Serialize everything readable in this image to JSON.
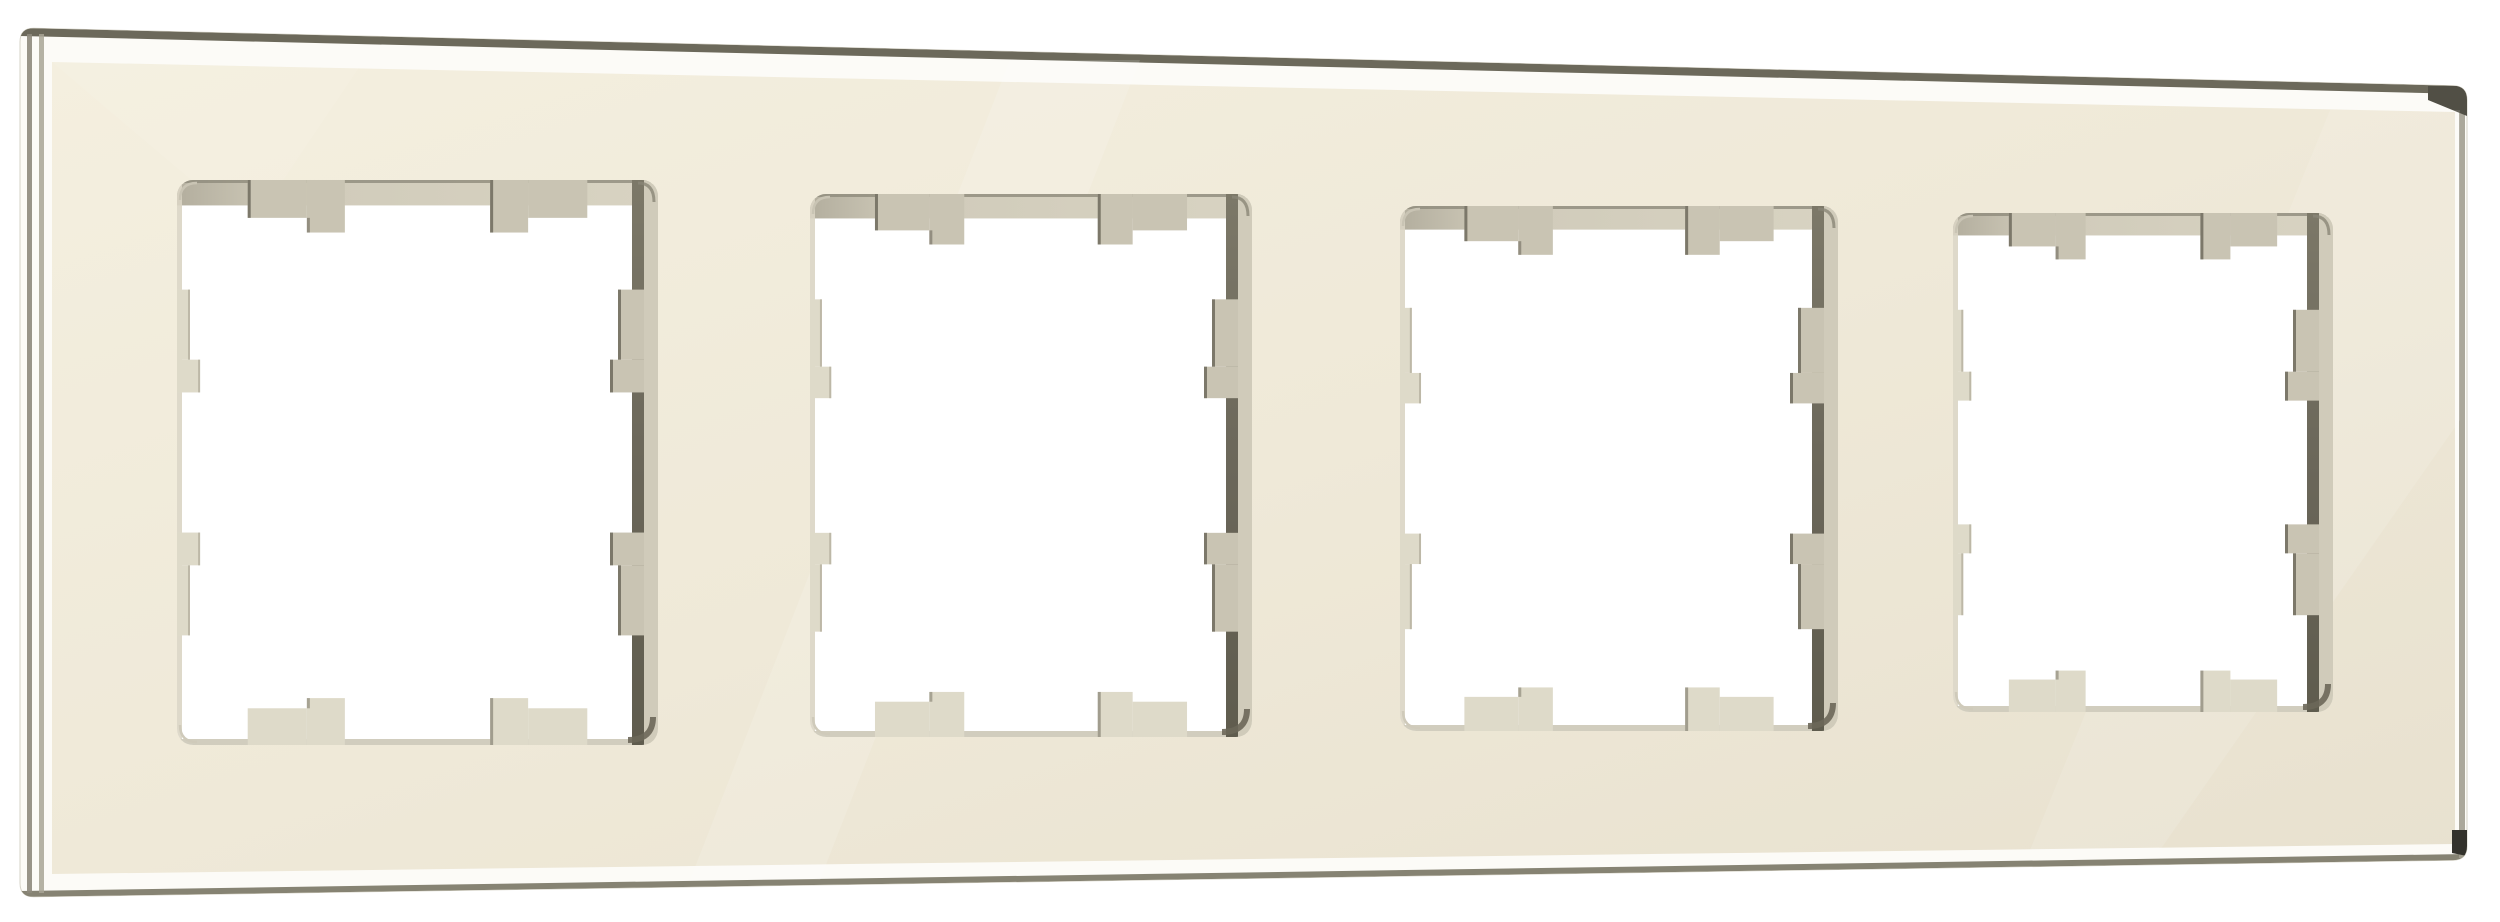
{
  "canvas": {
    "width": 2500,
    "height": 922,
    "background": "#ffffff"
  },
  "product": {
    "description": "Four-gang ivory glass frame for wall switches and sockets, front view, no visible text",
    "gang_count": 4
  },
  "palette": {
    "page_bg": "#ffffff",
    "edge_white": "#fcfbf7",
    "edge_outline": "#d6d3c7",
    "top_dark_line": "#6c695b",
    "left_line_1": "#8e8a7c",
    "left_line_2": "#a8a495",
    "bottom_line": "#7f7c6b",
    "right_line": "#a29e90",
    "corner_wedge": "#514f45",
    "corner_nub": "#33322c",
    "face_light": "#f4efdf",
    "face_mid": "#efe9d8",
    "face_dark": "#e8e1cf",
    "hole_white": "#ffffff",
    "top_reveal_dark": "#b3ae9e",
    "top_reveal_mid": "#d0cbba",
    "top_reveal_light": "#d8d3c2",
    "top_reveal_line": "#8f8b7c",
    "tab_shadow": "#c9c4b3",
    "tab_dark_edge": "#6f6b5d",
    "tab_lit": "#dedac9",
    "tab_lit_edge": "#bdb8a7",
    "right_bevel_top": "#7c7868",
    "right_bevel_mid": "#6b675a",
    "right_bevel_bottom": "#5f5c4e",
    "right_outer_strip": "#d0cbba",
    "left_reveal": "#dad5c4",
    "bottom_reveal": "#cfcaba",
    "corner_tl": "#c9c4b4",
    "corner_tr": "#8a8677",
    "corner_br": "#6b6759",
    "corner_bl": "#cfcaba",
    "sheen": "#ffffff"
  },
  "frame": {
    "outer": [
      [
        20,
        28
      ],
      [
        2467,
        86
      ],
      [
        2467,
        860
      ],
      [
        20,
        897
      ]
    ],
    "outer_radius": 14,
    "face": [
      [
        52,
        62
      ],
      [
        2455,
        112
      ],
      [
        2455,
        844
      ],
      [
        52,
        874
      ]
    ],
    "top_band": [
      [
        20,
        28
      ],
      [
        2467,
        86
      ],
      [
        2467,
        94
      ],
      [
        20,
        36
      ]
    ],
    "bottom_band": [
      [
        20,
        891
      ],
      [
        2467,
        854
      ],
      [
        2467,
        860
      ],
      [
        20,
        897
      ]
    ],
    "left_lines_x": [
      27,
      39
    ],
    "left_line_width": 5,
    "left_line_y1": 34,
    "left_line_y2": 893,
    "right_line": {
      "x": 2459,
      "w": 6,
      "y1": 88,
      "y2": 858
    },
    "tr_wedge": [
      [
        2428,
        86
      ],
      [
        2467,
        86
      ],
      [
        2467,
        116
      ],
      [
        2428,
        100
      ]
    ],
    "br_nub": [
      [
        2452,
        830
      ],
      [
        2467,
        830
      ],
      [
        2467,
        856
      ],
      [
        2452,
        853
      ]
    ]
  },
  "sheens": [
    {
      "points": [
        [
          690,
          880
        ],
        [
          1010,
          60
        ],
        [
          1140,
          60
        ],
        [
          820,
          880
        ]
      ],
      "opacity": 0.14
    },
    {
      "points": [
        [
          2030,
          850
        ],
        [
          2330,
          110
        ],
        [
          2460,
          110
        ],
        [
          2460,
          420
        ],
        [
          2160,
          850
        ]
      ],
      "opacity": 0.12
    },
    {
      "points": [
        [
          52,
          62
        ],
        [
          360,
          66
        ],
        [
          250,
          230
        ]
      ],
      "opacity": 0.08
    }
  ],
  "openings": [
    {
      "x1": 177,
      "y1": 180,
      "x2": 658,
      "y2": 745
    },
    {
      "x1": 810,
      "y1": 194,
      "x2": 1252,
      "y2": 737
    },
    {
      "x1": 1400,
      "y1": 206,
      "x2": 1838,
      "y2": 731
    },
    {
      "x1": 1953,
      "y1": 213,
      "x2": 2333,
      "y2": 712
    }
  ],
  "opening_style": {
    "corner_radius": 16,
    "top_line_h": 3,
    "top_band_h": 0.045,
    "top_tab": {
      "offset": 0.147,
      "shallow_w": 0.123,
      "deep_w": 0.079,
      "shallow_d": 0.067,
      "deep_d": 0.093
    },
    "bottom_tab": {
      "offset": 0.147,
      "shallow_w": 0.123,
      "deep_w": 0.079,
      "shallow_d": 0.065,
      "deep_d": 0.083
    },
    "side_tab": {
      "offset": 0.194,
      "shallow_l": 0.124,
      "deep_l": 0.058,
      "left_shallow_d": 0.027,
      "left_deep_d": 0.048,
      "right_shallow_px": 14,
      "right_deep_px": 22
    },
    "left_reveal_w": 5,
    "bottom_reveal_h": 6,
    "right_dark_w": 12,
    "right_outer_w": 14
  }
}
